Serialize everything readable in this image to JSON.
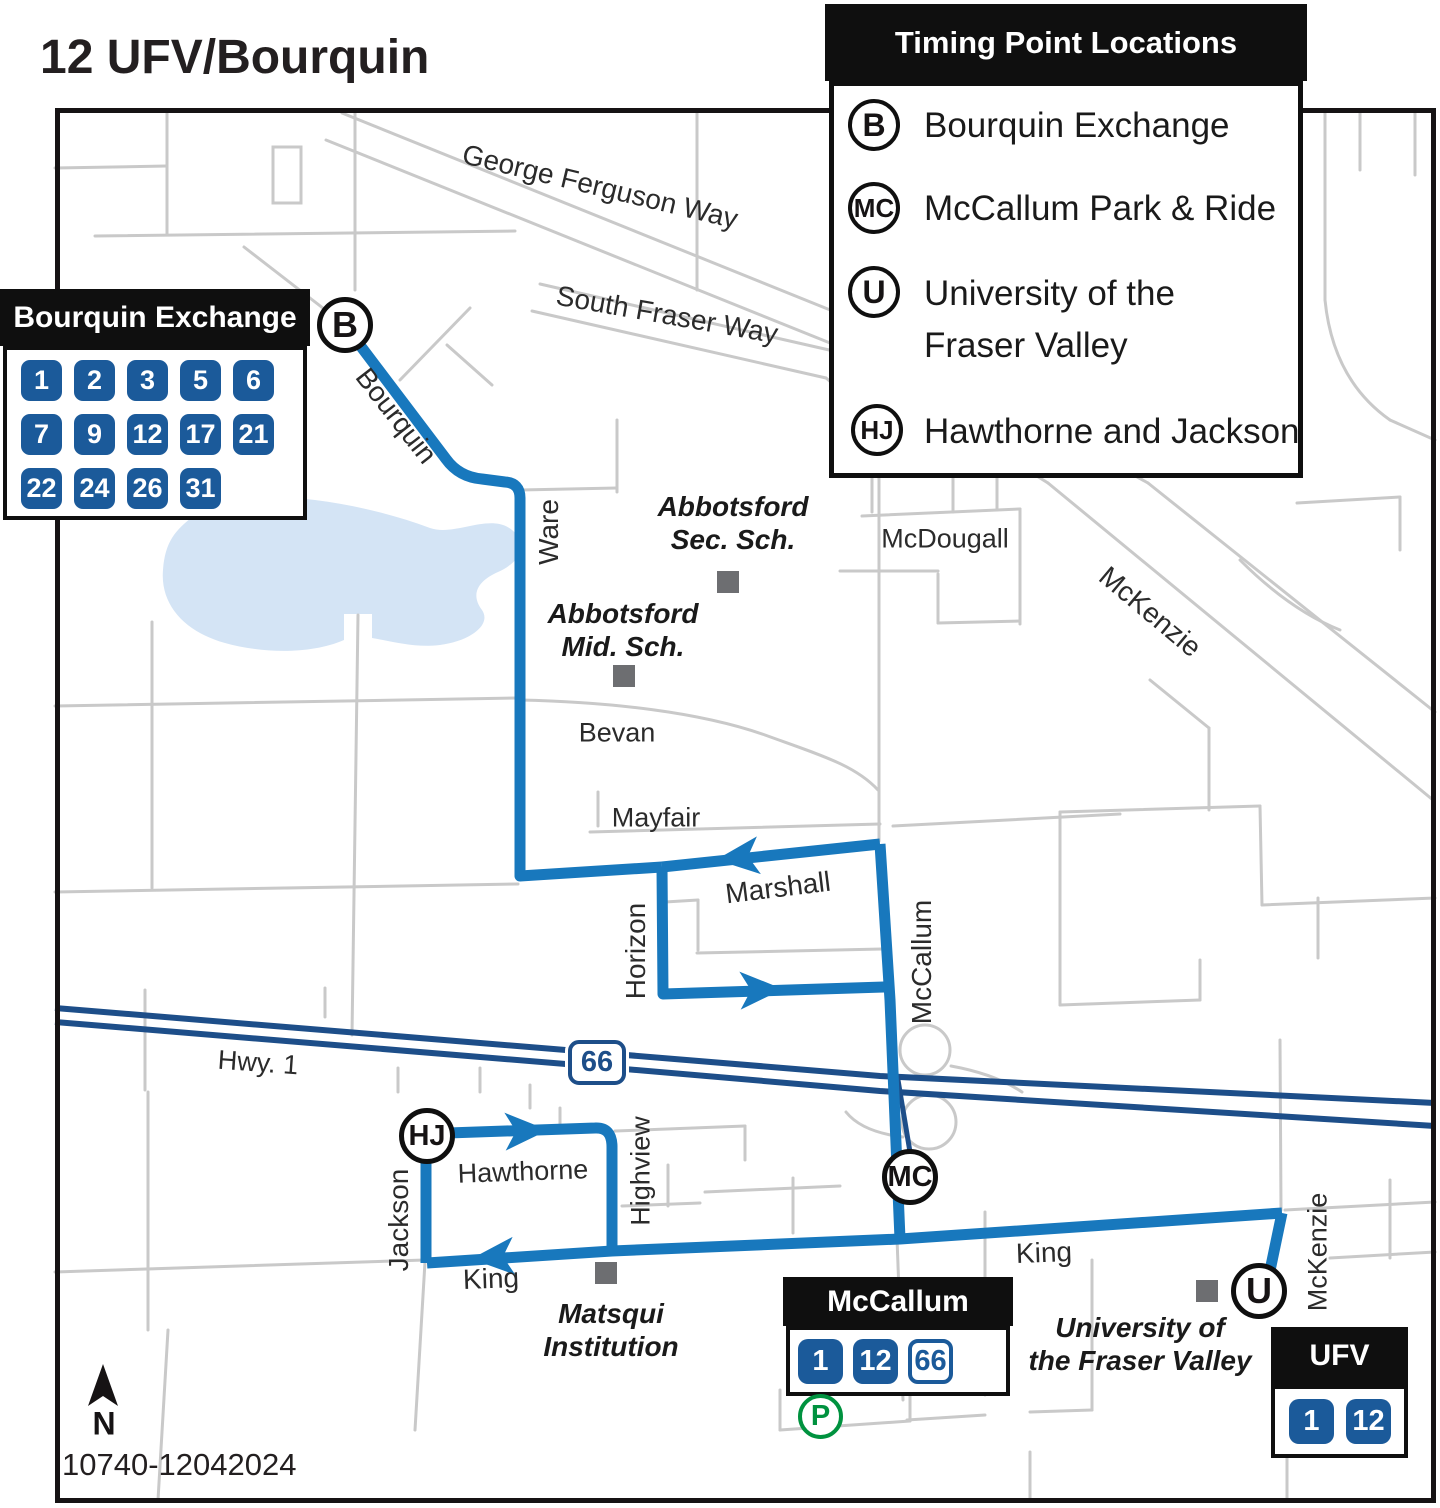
{
  "page_title": "12 UFV/Bourquin",
  "timing_legend": {
    "title": "Timing Point Locations",
    "items": [
      {
        "code": "B",
        "line1": "Bourquin Exchange",
        "line2": ""
      },
      {
        "code": "MC",
        "line1": "McCallum Park & Ride",
        "line2": ""
      },
      {
        "code": "U",
        "line1": "University of the",
        "line2": "Fraser Valley"
      },
      {
        "code": "HJ",
        "line1": "Hawthorne and Jackson",
        "line2": ""
      }
    ]
  },
  "stops": {
    "bourquin": {
      "title": "Bourquin Exchange",
      "routes": [
        "1",
        "2",
        "3",
        "5",
        "6",
        "7",
        "9",
        "12",
        "17",
        "21",
        "22",
        "24",
        "26",
        "31"
      ]
    },
    "mccallum": {
      "title": "McCallum",
      "routes": [
        "1",
        "12"
      ],
      "outlined_route": "66",
      "parking": "P"
    },
    "ufv": {
      "title": "UFV",
      "routes": [
        "1",
        "12"
      ]
    }
  },
  "timing_points": {
    "b": "B",
    "mc": "MC",
    "u": "U",
    "hj": "HJ"
  },
  "streets": {
    "george_ferguson": "George Ferguson Way",
    "south_fraser": "South Fraser Way",
    "bourquin": "Bourquin",
    "ware": "Ware",
    "mcdougall": "McDougall",
    "mckenzie": "McKenzie",
    "bevan": "Bevan",
    "mayfair": "Mayfair",
    "marshall": "Marshall",
    "horizon": "Horizon",
    "mccallum": "McCallum",
    "hawthorne": "Hawthorne",
    "jackson": "Jackson",
    "highview": "Highview",
    "king": "King"
  },
  "landmarks": {
    "abbotsford_sec": {
      "line1": "Abbotsford",
      "line2": "Sec. Sch."
    },
    "abbotsford_mid": {
      "line1": "Abbotsford",
      "line2": "Mid. Sch."
    },
    "matsqui": {
      "line1": "Matsqui",
      "line2": "Institution"
    },
    "ufv": {
      "line1": "University of",
      "line2": "the Fraser Valley"
    }
  },
  "highway": {
    "shield": "66",
    "name": "Hwy. 1"
  },
  "compass_north": "N",
  "map_code": "10740-12042024",
  "colors": {
    "route_blue": "#1878bd",
    "highway_navy": "#1d4e89",
    "badge_blue": "#1b5a9a",
    "parking_green": "#00923f",
    "street_gray": "#c9c9c9",
    "lake_blue": "#d4e4f5",
    "marker_gray": "#6d6e71",
    "text_black": "#231f20"
  }
}
